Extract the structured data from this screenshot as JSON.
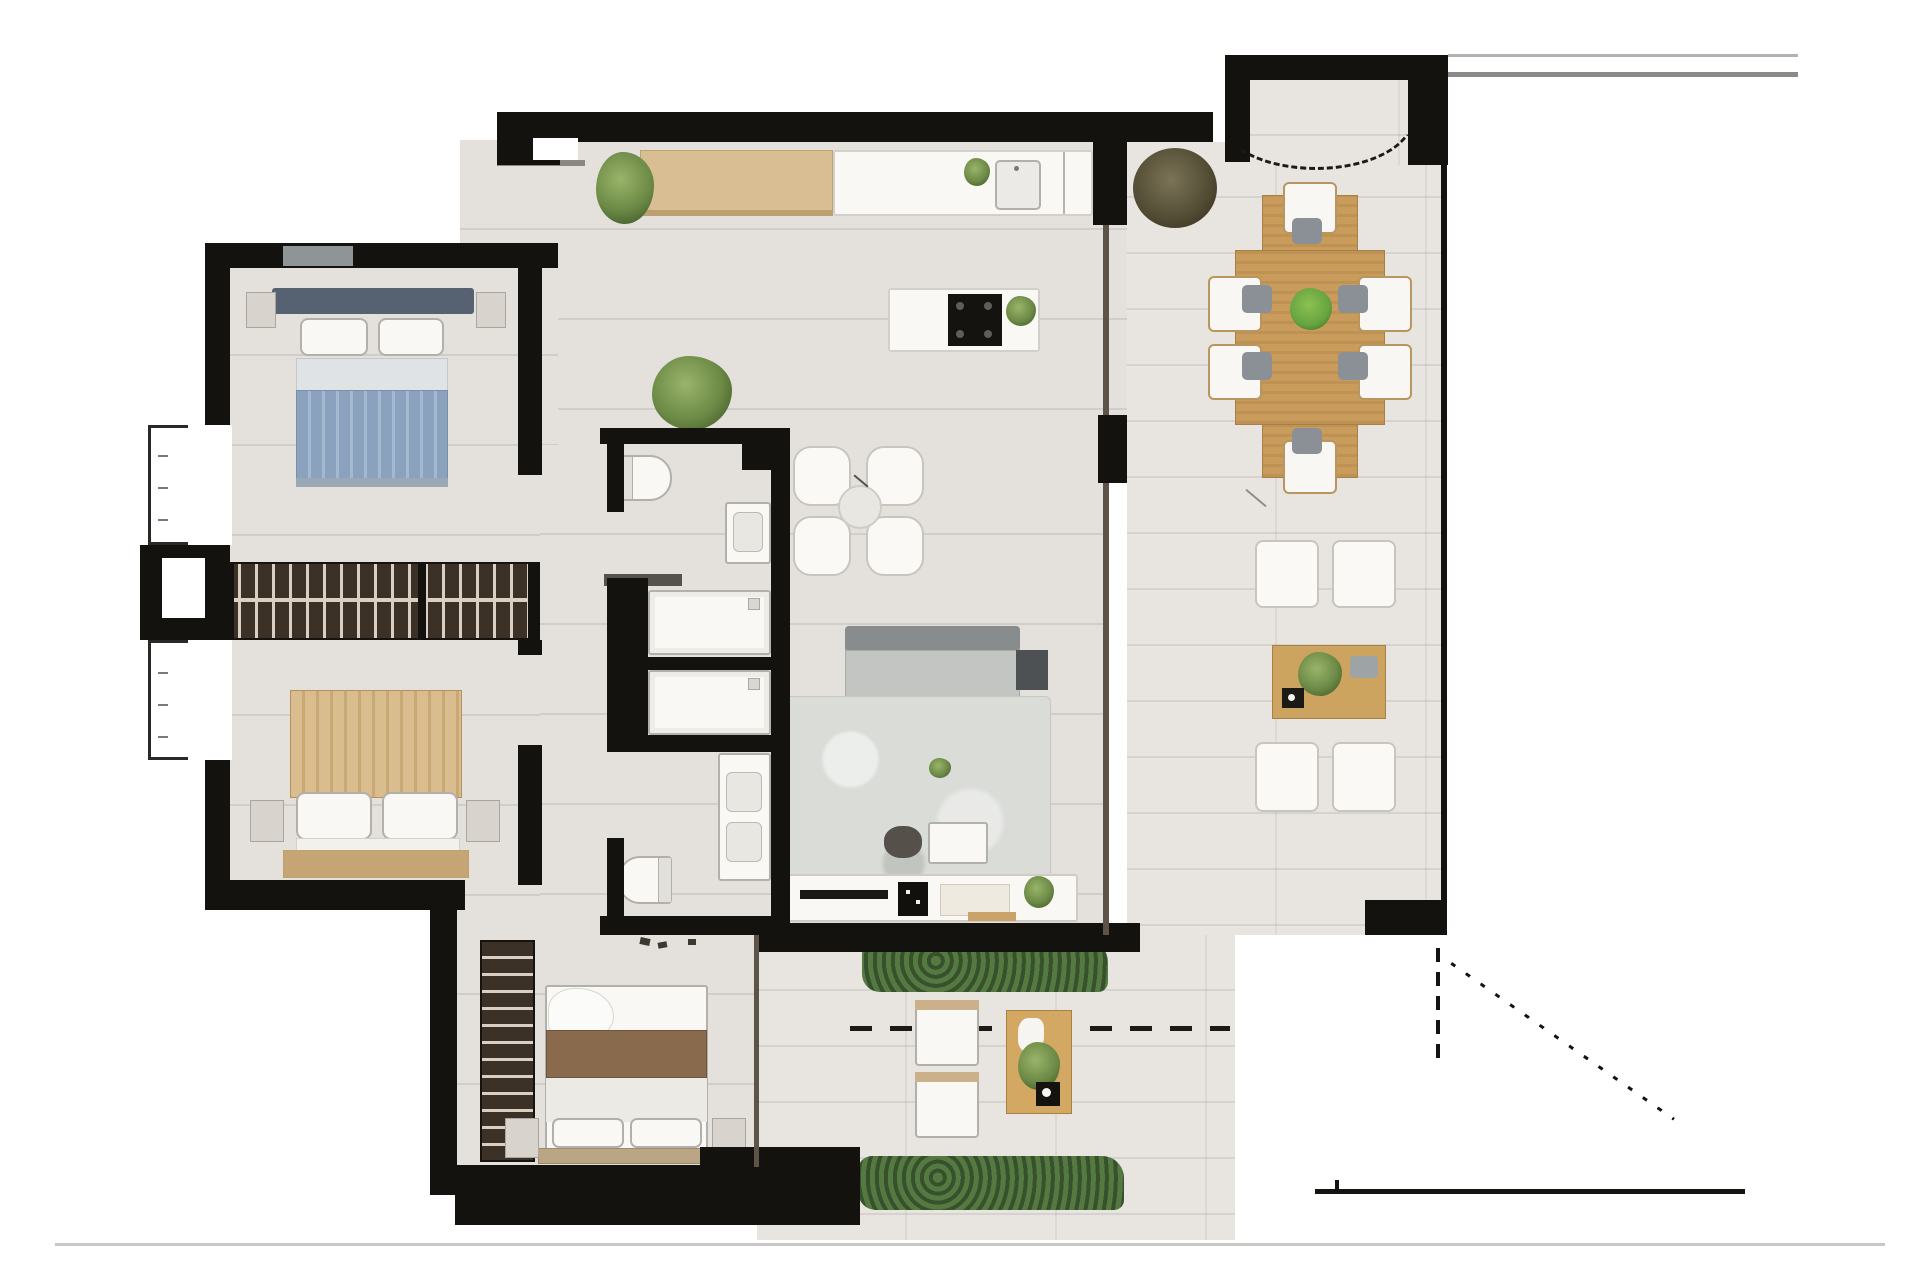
{
  "page": {
    "background": "#ffffff",
    "baseline_color": "#c9c7c4"
  },
  "plan": {
    "aria_label": "Rendered apartment floor plan with furniture and wrap-around terrace",
    "type": "apartment-floor-plan",
    "colors": {
      "wall": "#14120f",
      "interior_floor": "#e4e1dd",
      "terrace_floor": "#e8e5e1",
      "wood_light": "#d9be94",
      "wood_dining": "#c99c5c",
      "wardrobe_dark": "#3c3127",
      "bed_blue": "#8aa2bd",
      "bed_tan": "#dabd8e",
      "master_throw_brown": "#8a6a4c",
      "rug_gray": "#dadcd8",
      "sofa_gray": "#c3c5c3",
      "plant_green": "#6c8a46",
      "plant_dark_olive": "#514b33",
      "hedge_green": "#37512c",
      "fixture_white": "#f9f8f5",
      "annotation_black": "#15130f",
      "property_line_gray": "#8c8a87"
    },
    "rooms": [
      "entry",
      "kitchen",
      "living-room",
      "breakfast-nook",
      "bedroom-top-left",
      "bedroom-bottom-left",
      "master-bedroom",
      "bathroom-top",
      "bathroom-middle",
      "guest-wc",
      "corridor",
      "stair-lobby",
      "terrace-right",
      "terrace-bottom"
    ],
    "furniture": [
      "blue-double-bed",
      "tan-double-bed",
      "master-bed-with-brown-throw",
      "back-to-back-wardrobe-band",
      "master-closet",
      "kitchen-counter-with-sink",
      "kitchen-island-with-cooktop",
      "wood-sideboard",
      "outdoor-dining-table-8-chairs",
      "outdoor-lounge-set-4-armchairs",
      "sofa-with-side-table",
      "area-rug",
      "coffee-table",
      "pouf",
      "tv-console",
      "nook-4-armchairs",
      "bathtub",
      "shower",
      "toilets",
      "vanity-sinks",
      "double-vanity",
      "two-sun-loungers",
      "outdoor-side-table",
      "potted-plants",
      "hedgerows"
    ],
    "annotations": [
      "door-swing-dashed-arc",
      "terrace-boundary-dashed-line",
      "diagonal-dotted-boundary",
      "property-lines-top-right",
      "bottom-solid-boundary-line",
      "window-symbols-left-wall",
      "page-baseline"
    ]
  }
}
